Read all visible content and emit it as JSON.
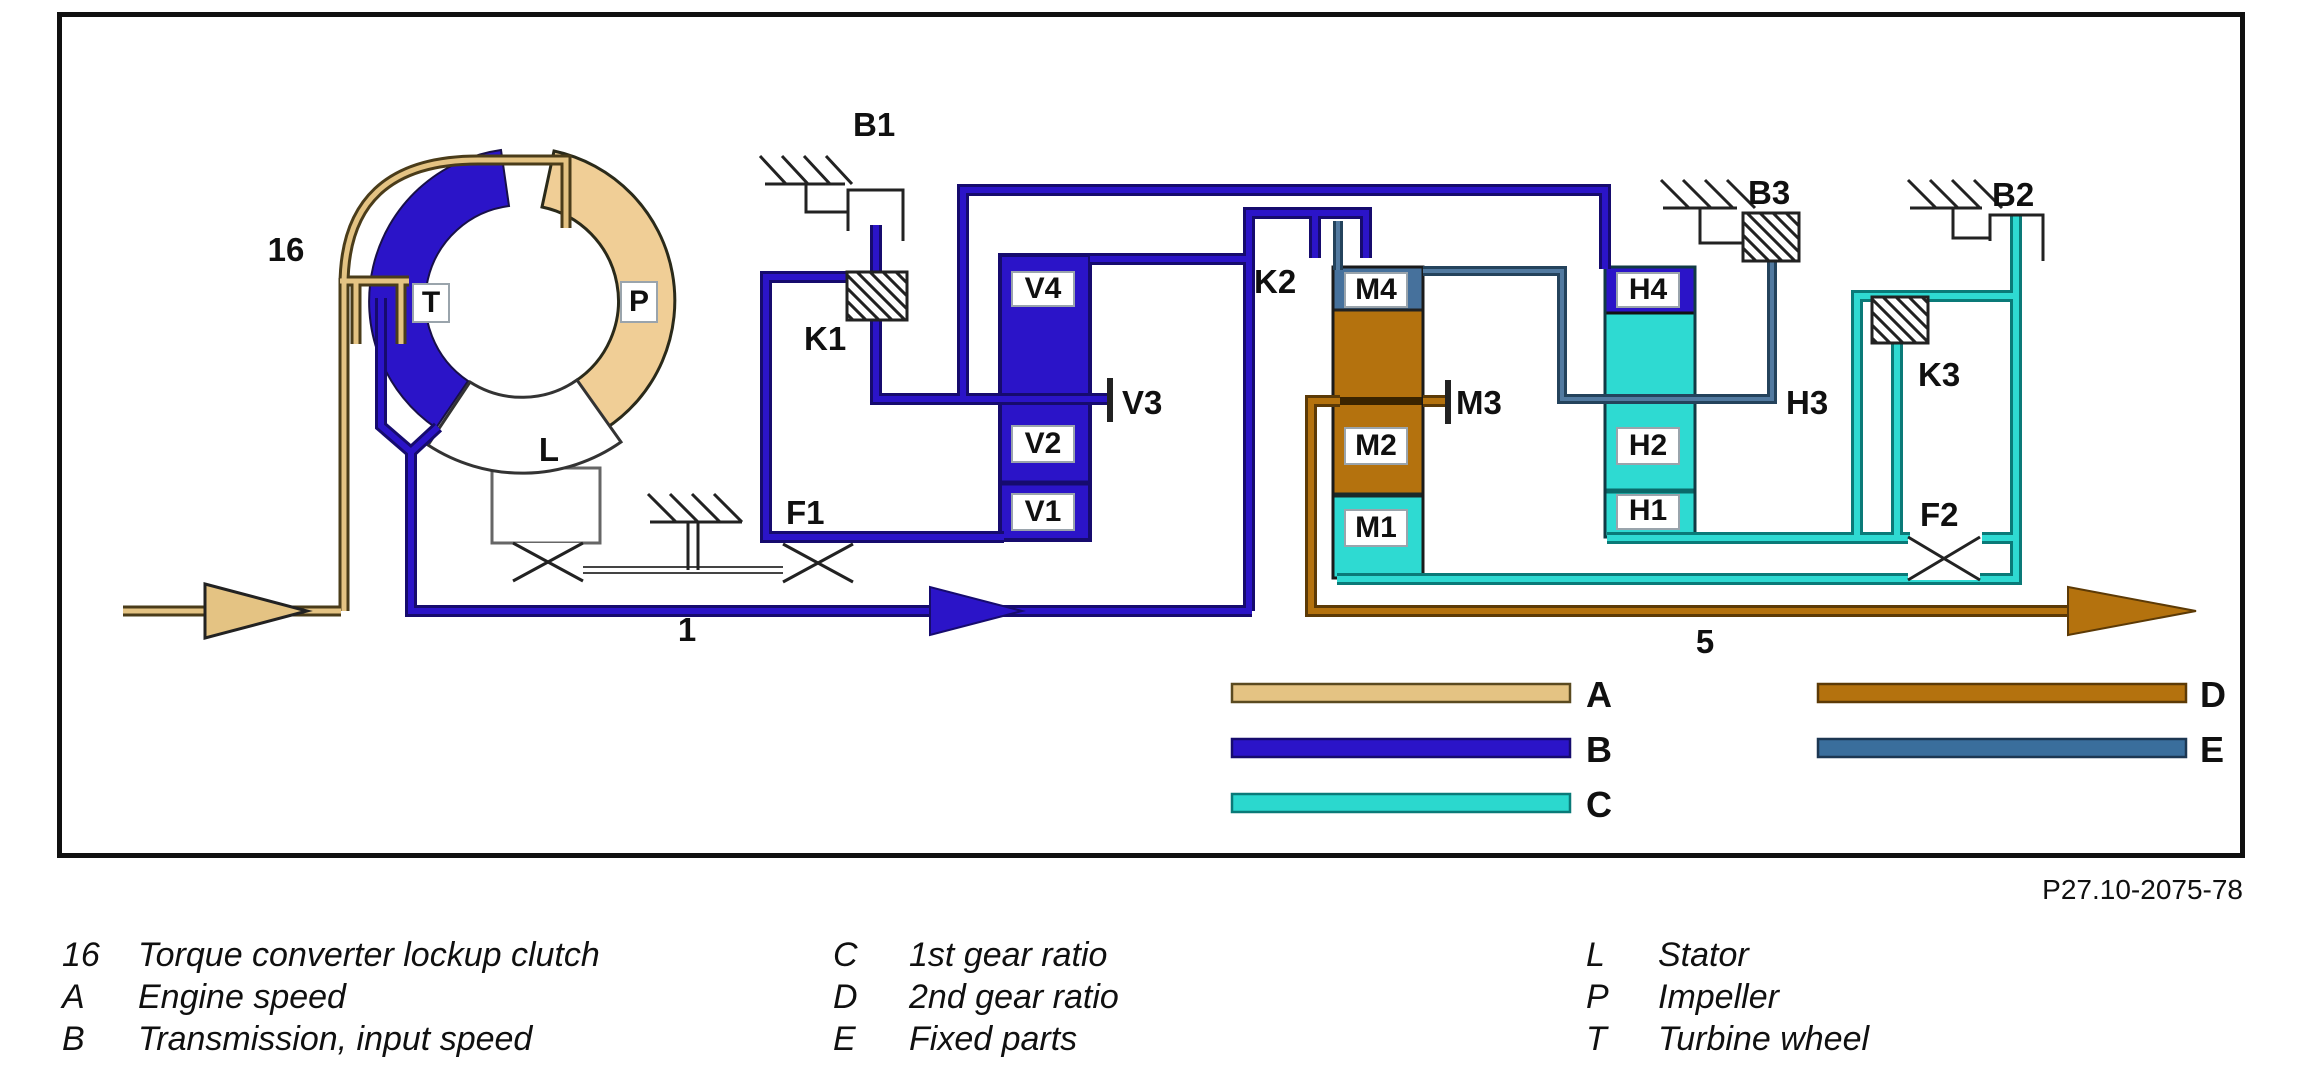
{
  "figure_code": "P27.10-2075-78",
  "colors": {
    "engine_speed": "#E4C383",
    "input_speed": "#2B14C8",
    "first_gear": "#2EDAD2",
    "second_gear": "#B4720E",
    "fixed_parts": "#3A6E9C"
  },
  "labels": {
    "item_16": "16",
    "shaft_1": "1",
    "shaft_5": "5",
    "turbine": "T",
    "impeller": "P",
    "stator": "L",
    "b1": "B1",
    "b2": "B2",
    "b3": "B3",
    "k1": "K1",
    "k2": "K2",
    "k3": "K3",
    "f1": "F1",
    "f2": "F2",
    "v1": "V1",
    "v2": "V2",
    "v3": "V3",
    "v4": "V4",
    "m1": "M1",
    "m2": "M2",
    "m3": "M3",
    "m4": "M4",
    "h1": "H1",
    "h2": "H2",
    "h3": "H3",
    "h4": "H4"
  },
  "legend_bars": [
    {
      "key": "A",
      "color": "#E4C383"
    },
    {
      "key": "B",
      "color": "#2B14C8"
    },
    {
      "key": "C",
      "color": "#2BD8CE"
    },
    {
      "key": "D",
      "color": "#B4720E"
    },
    {
      "key": "E",
      "color": "#3A6E9C"
    }
  ],
  "legend": [
    {
      "key": "16",
      "text": "Torque converter lockup clutch"
    },
    {
      "key": "A",
      "text": "Engine speed"
    },
    {
      "key": "B",
      "text": "Transmission, input speed"
    },
    {
      "key": "C",
      "text": "1st gear ratio"
    },
    {
      "key": "D",
      "text": "2nd gear ratio"
    },
    {
      "key": "E",
      "text": "Fixed parts"
    },
    {
      "key": "L",
      "text": "Stator"
    },
    {
      "key": "P",
      "text": "Impeller"
    },
    {
      "key": "T",
      "text": "Turbine wheel"
    }
  ]
}
